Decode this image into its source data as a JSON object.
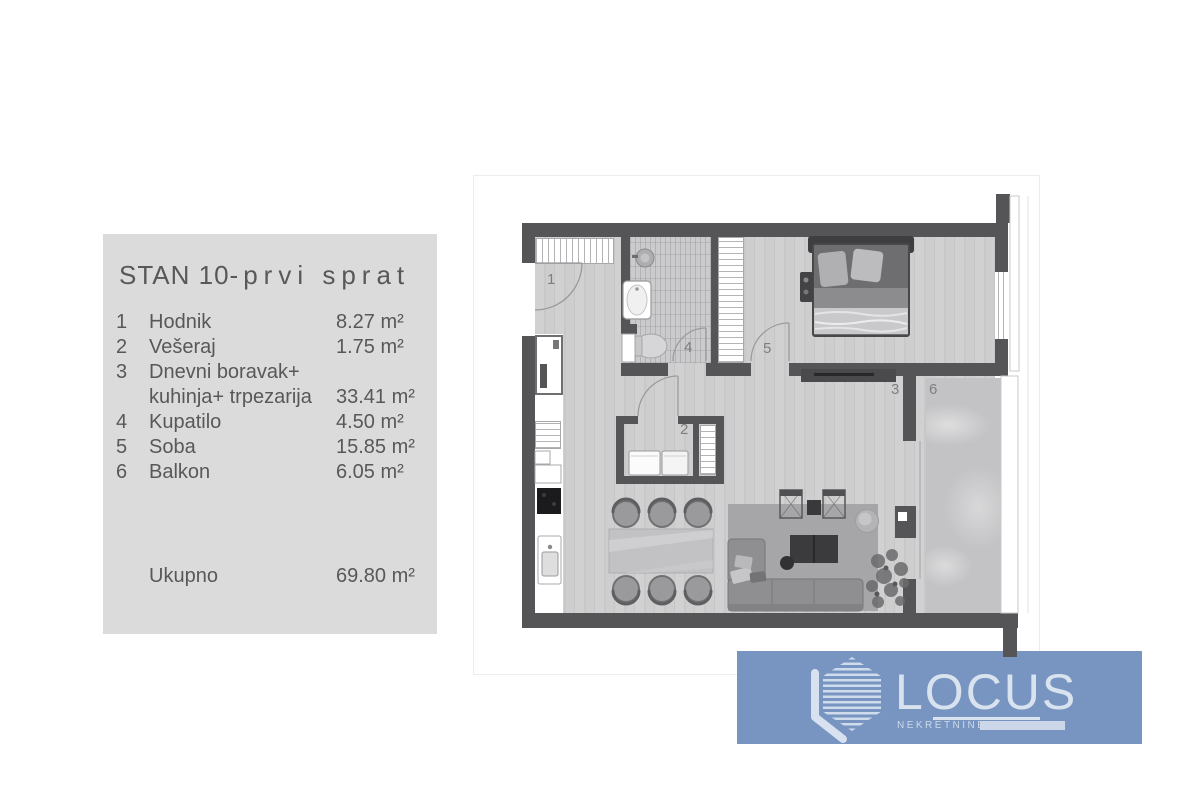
{
  "panel": {
    "title_main": "STAN 10-",
    "title_sub": "prvi sprat",
    "rows": [
      {
        "num": "1",
        "name": "Hodnik",
        "area": "8.27 m²"
      },
      {
        "num": "2",
        "name": "Vešeraj",
        "area": "1.75 m²"
      },
      {
        "num": "3",
        "name": "Dnevni boravak+",
        "name2": "kuhinja+ trpezarija",
        "area": "33.41 m²"
      },
      {
        "num": "4",
        "name": "Kupatilo",
        "area": "4.50 m²"
      },
      {
        "num": "5",
        "name": "Soba",
        "area": "15.85 m²"
      },
      {
        "num": "6",
        "name": "Balkon",
        "area": "6.05 m²"
      }
    ],
    "total_label": "Ukupno",
    "total_area": "69.80 m²",
    "colors": {
      "panel_bg": "#dbdbdb",
      "text": "#58585a"
    }
  },
  "plan": {
    "labels": {
      "hallway": "1",
      "laundry": "2",
      "living": "3",
      "bathroom": "4",
      "bedroom": "5",
      "balcony": "6"
    },
    "colors": {
      "wall": "#555558",
      "wood_floor": "#cdcdce",
      "tile": "#cbcbcd",
      "marble": "#c3c3c5",
      "rug": "#a6a6a8"
    }
  },
  "logo": {
    "brand": "LOCUS",
    "tagline": "NEKRETNINE",
    "colors": {
      "banner_bg": "#7795c0",
      "logo_light": "#d9e2ef"
    }
  }
}
